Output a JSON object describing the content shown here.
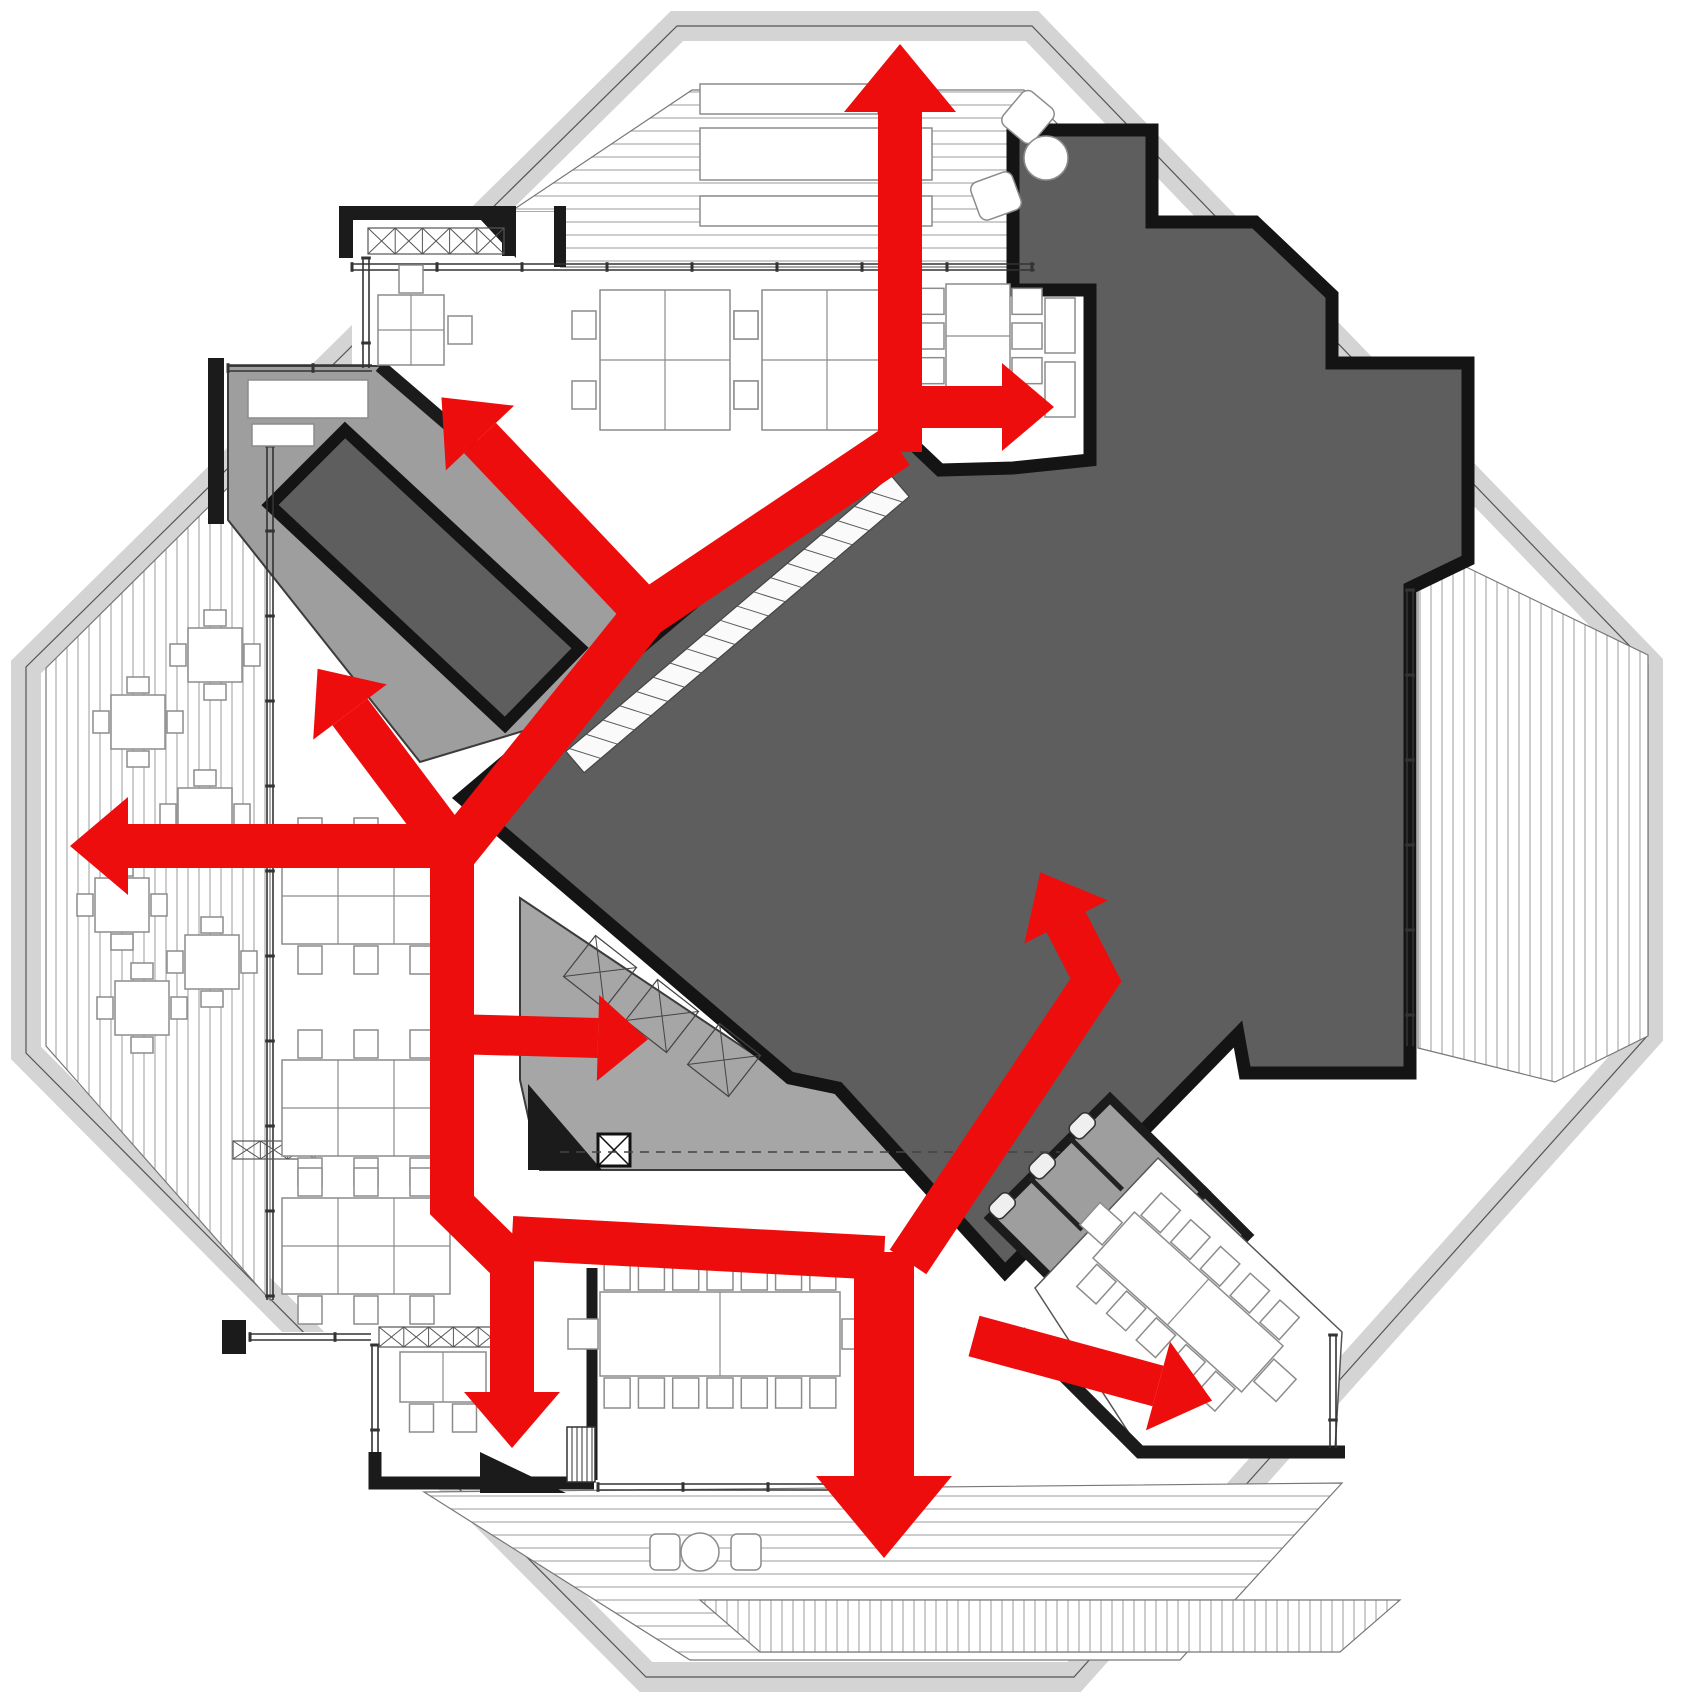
{
  "meta": {
    "kind": "architectural-floor-plan-circulation-diagram",
    "canvas": {
      "w": 1700,
      "h": 1701
    }
  },
  "palette": {
    "red": "#ee0d0d",
    "core_gray": "#5e5e5e",
    "core_stroke": "#141414",
    "room_gray": "#9e9e9e",
    "service_gray": "#a6a6a6",
    "band_gray": "#d4d4d4",
    "deck_line": "#b2b2b2",
    "wall_black": "#1b1b1b",
    "thin_line": "#3c3c3c",
    "furniture_line": "#8c8c8c",
    "white": "#ffffff",
    "hatch_line": "#5a5a5a"
  },
  "octagon": {
    "outer": [
      [
        672,
        14
      ],
      [
        1037,
        14
      ],
      [
        1660,
        660
      ],
      [
        1660,
        1040
      ],
      [
        1080,
        1689
      ],
      [
        640,
        1689
      ],
      [
        14,
        1059
      ],
      [
        14,
        662
      ]
    ],
    "inner": [
      [
        677,
        26
      ],
      [
        1032,
        26
      ],
      [
        1648,
        665
      ],
      [
        1648,
        1035
      ],
      [
        1074,
        1677
      ],
      [
        646,
        1677
      ],
      [
        26,
        1053
      ],
      [
        26,
        667
      ]
    ],
    "band_width": 30
  },
  "terraces": [
    {
      "name": "terrace-north",
      "pattern": "h",
      "points": [
        [
          692,
          90
        ],
        [
          1024,
          90
        ],
        [
          1160,
          228
        ],
        [
          1160,
          267
        ],
        [
          560,
          267
        ],
        [
          560,
          212
        ],
        [
          510,
          212
        ]
      ]
    },
    {
      "name": "terrace-west",
      "pattern": "v",
      "points": [
        [
          46,
          668
        ],
        [
          270,
          446
        ],
        [
          270,
          1300
        ],
        [
          46,
          1046
        ]
      ]
    },
    {
      "name": "terrace-east",
      "pattern": "v",
      "points": [
        [
          1418,
          588
        ],
        [
          1462,
          565
        ],
        [
          1648,
          655
        ],
        [
          1648,
          1036
        ],
        [
          1555,
          1082
        ],
        [
          1418,
          1048
        ]
      ]
    },
    {
      "name": "terrace-south",
      "pattern": "h",
      "points": [
        [
          424,
          1492
        ],
        [
          1342,
          1483
        ],
        [
          1180,
          1660
        ],
        [
          690,
          1660
        ]
      ]
    },
    {
      "name": "terrace-south-lower-strip",
      "pattern": "v",
      "points": [
        [
          700,
          1600
        ],
        [
          1400,
          1600
        ],
        [
          1340,
          1652
        ],
        [
          760,
          1652
        ]
      ]
    }
  ],
  "rooms": [
    {
      "name": "office-top-left",
      "fill": "white",
      "stroke": "none",
      "w": 0,
      "points": [
        [
          352,
          212
        ],
        [
          560,
          212
        ],
        [
          560,
          460
        ],
        [
          352,
          460
        ]
      ]
    },
    {
      "name": "room-sw-office",
      "fill": "white",
      "stroke": "none",
      "w": 0,
      "points": [
        [
          234,
          1332
        ],
        [
          590,
          1332
        ],
        [
          590,
          1483
        ],
        [
          375,
          1483
        ],
        [
          234,
          1355
        ]
      ]
    },
    {
      "name": "meeting-anteroom",
      "fill": "room_gray",
      "stroke": "thin_line",
      "w": 2,
      "points": [
        [
          228,
          366
        ],
        [
          380,
          366
        ],
        [
          652,
          600
        ],
        [
          560,
          720
        ],
        [
          420,
          762
        ],
        [
          228,
          520
        ]
      ]
    },
    {
      "name": "service-area",
      "fill": "service_gray",
      "stroke": "thin_line",
      "w": 2,
      "points": [
        [
          520,
          898
        ],
        [
          792,
          1080
        ],
        [
          1085,
          1080
        ],
        [
          1085,
          1170
        ],
        [
          540,
          1170
        ],
        [
          520,
          1080
        ]
      ]
    }
  ],
  "core": {
    "name": "central-core-mass",
    "points": [
      [
        462,
        798
      ],
      [
        898,
        430
      ],
      [
        940,
        470
      ],
      [
        1013,
        468
      ],
      [
        1090,
        460
      ],
      [
        1090,
        290
      ],
      [
        1013,
        290
      ],
      [
        1013,
        130
      ],
      [
        1152,
        130
      ],
      [
        1152,
        222
      ],
      [
        1255,
        222
      ],
      [
        1332,
        295
      ],
      [
        1332,
        363
      ],
      [
        1468,
        363
      ],
      [
        1468,
        560
      ],
      [
        1410,
        588
      ],
      [
        1410,
        1073
      ],
      [
        1245,
        1073
      ],
      [
        1238,
        1034
      ],
      [
        1005,
        1272
      ],
      [
        838,
        1088
      ],
      [
        790,
        1078
      ]
    ]
  },
  "meeting_room_rotated": {
    "name": "meeting-room-dark",
    "points": [
      [
        345,
        430
      ],
      [
        580,
        648
      ],
      [
        505,
        725
      ],
      [
        270,
        505
      ]
    ]
  },
  "toilets": {
    "block": [
      [
        1110,
        1098
      ],
      [
        1205,
        1192
      ],
      [
        1085,
        1312
      ],
      [
        990,
        1218
      ]
    ],
    "washroom": [
      [
        1205,
        1192
      ],
      [
        1248,
        1235
      ],
      [
        1128,
        1355
      ],
      [
        1085,
        1312
      ]
    ]
  },
  "se_meeting_room": {
    "name": "meeting-room-se",
    "points": [
      [
        1035,
        1288
      ],
      [
        1158,
        1158
      ],
      [
        1342,
        1332
      ],
      [
        1335,
        1450
      ],
      [
        1140,
        1450
      ]
    ]
  },
  "walls": [
    {
      "name": "wall-tl-office-top",
      "w": 14,
      "points": [
        [
          346,
          258
        ],
        [
          346,
          213
        ],
        [
          509,
          213
        ],
        [
          509,
          256
        ]
      ]
    },
    {
      "name": "wall-tl-office-divider",
      "w": 12,
      "points": [
        [
          560,
          206
        ],
        [
          560,
          267
        ]
      ]
    },
    {
      "name": "wall-anteroom-west",
      "w": 16,
      "points": [
        [
          216,
          358
        ],
        [
          216,
          524
        ]
      ]
    },
    {
      "name": "wall-anteroom-diagonal",
      "w": 13,
      "points": [
        [
          380,
          366
        ],
        [
          652,
          600
        ]
      ]
    },
    {
      "name": "wall-sw-corner",
      "w": 24,
      "points": [
        [
          234,
          1320
        ],
        [
          234,
          1354
        ]
      ]
    },
    {
      "name": "wall-s-left",
      "w": 13,
      "points": [
        [
          375,
          1452
        ],
        [
          375,
          1483
        ],
        [
          594,
          1483
        ]
      ]
    },
    {
      "name": "wall-conference-west",
      "w": 11,
      "points": [
        [
          592,
          1268
        ],
        [
          592,
          1480
        ]
      ]
    },
    {
      "name": "wall-se-room-southwest",
      "w": 13,
      "points": [
        [
          1020,
          1332
        ],
        [
          1140,
          1452
        ],
        [
          1345,
          1452
        ]
      ]
    }
  ],
  "wall_wedges": [
    {
      "name": "pier-tl-office",
      "points": [
        [
          468,
          206
        ],
        [
          516,
          206
        ],
        [
          516,
          258
        ]
      ]
    },
    {
      "name": "pier-s-wall",
      "points": [
        [
          480,
          1452
        ],
        [
          566,
          1493
        ],
        [
          480,
          1493
        ]
      ]
    },
    {
      "name": "pier-service-west",
      "points": [
        [
          528,
          1084
        ],
        [
          602,
          1170
        ],
        [
          528,
          1170
        ]
      ]
    }
  ],
  "windows": [
    {
      "name": "window-north-office",
      "a": [
        352,
        267
      ],
      "b": [
        1035,
        267
      ]
    },
    {
      "name": "window-tl-office",
      "a": [
        366,
        258
      ],
      "b": [
        366,
        368
      ]
    },
    {
      "name": "window-anteroom",
      "a": [
        228,
        368
      ],
      "b": [
        372,
        368
      ]
    },
    {
      "name": "window-west-office",
      "a": [
        270,
        446
      ],
      "b": [
        270,
        1300
      ]
    },
    {
      "name": "window-core-east",
      "a": [
        1410,
        590
      ],
      "b": [
        1410,
        1046
      ]
    },
    {
      "name": "window-se-room",
      "a": [
        1333,
        1335
      ],
      "b": [
        1333,
        1448
      ]
    },
    {
      "name": "window-sw-room-top",
      "a": [
        250,
        1337
      ],
      "b": [
        371,
        1337
      ]
    },
    {
      "name": "window-sw-room-right",
      "a": [
        375,
        1345
      ],
      "b": [
        375,
        1452
      ]
    },
    {
      "name": "window-conference-south",
      "a": [
        598,
        1487
      ],
      "b": [
        858,
        1487
      ]
    }
  ],
  "xbands": [
    {
      "name": "hatch-band-tl-office",
      "x": 368,
      "y": 228,
      "w": 136,
      "h": 26,
      "cells": 5
    },
    {
      "name": "hatch-band-sw-room",
      "x": 379,
      "y": 1327,
      "w": 124,
      "h": 20,
      "cells": 5
    },
    {
      "name": "hatch-band-west-office",
      "x": 233,
      "y": 1141,
      "w": 82,
      "h": 18,
      "cells": 3
    }
  ],
  "ladder_stair": {
    "name": "stair-ladder-core-edge",
    "a": [
      575,
      762
    ],
    "b": [
      900,
      486
    ],
    "w": 28,
    "step": 22
  },
  "stair_south": {
    "name": "stair-south-exit",
    "x": 567,
    "y": 1427,
    "w": 28,
    "h": 55,
    "gap": 5
  },
  "furniture": {
    "desk_clusters": [
      {
        "name": "desks-north-1",
        "x": 600,
        "y": 290,
        "w": 130,
        "h": 140,
        "rows": 2,
        "cols": 2,
        "left": 2,
        "right": 2,
        "top": 0,
        "bottom": 0
      },
      {
        "name": "desks-north-2",
        "x": 762,
        "y": 290,
        "w": 130,
        "h": 140,
        "rows": 2,
        "cols": 2,
        "left": 2,
        "right": 2,
        "top": 0,
        "bottom": 0
      },
      {
        "name": "desks-west-1",
        "x": 282,
        "y": 848,
        "w": 168,
        "h": 96,
        "rows": 2,
        "cols": 3,
        "left": 0,
        "right": 0,
        "top": 3,
        "bottom": 3
      },
      {
        "name": "desks-west-2",
        "x": 282,
        "y": 1060,
        "w": 168,
        "h": 96,
        "rows": 2,
        "cols": 3,
        "left": 0,
        "right": 0,
        "top": 3,
        "bottom": 3
      },
      {
        "name": "desks-west-3",
        "x": 282,
        "y": 1198,
        "w": 168,
        "h": 96,
        "rows": 2,
        "cols": 3,
        "left": 0,
        "right": 0,
        "top": 3,
        "bottom": 3
      },
      {
        "name": "desks-tl-office",
        "x": 378,
        "y": 295,
        "w": 66,
        "h": 70,
        "rows": 2,
        "cols": 2,
        "left": 0,
        "right": 1,
        "top": 1,
        "bottom": 0
      },
      {
        "name": "desks-sw-room",
        "x": 400,
        "y": 1352,
        "w": 86,
        "h": 50,
        "rows": 1,
        "cols": 2,
        "left": 0,
        "right": 0,
        "top": 0,
        "bottom": 2
      }
    ],
    "meeting_tables": [
      {
        "name": "table-north-east",
        "cx": 978,
        "cy": 336,
        "len": 104,
        "wid": 64,
        "rot": 90,
        "side": 3,
        "ends": 0
      },
      {
        "name": "table-conference",
        "cx": 720,
        "cy": 1334,
        "len": 240,
        "wid": 84,
        "rot": 0,
        "side": 7,
        "ends": 1
      },
      {
        "name": "table-se-meeting",
        "cx": 1188,
        "cy": 1302,
        "len": 200,
        "wid": 62,
        "rot": 42,
        "side": 5,
        "ends": 1
      }
    ],
    "cafe_tables": [
      [
        215,
        655
      ],
      [
        138,
        722
      ],
      [
        205,
        815
      ],
      [
        122,
        905
      ],
      [
        212,
        962
      ],
      [
        142,
        1008
      ]
    ],
    "planters": [
      {
        "x": 700,
        "y": 84,
        "w": 178,
        "h": 30
      },
      {
        "x": 700,
        "y": 128,
        "w": 232,
        "h": 52
      },
      {
        "x": 700,
        "y": 196,
        "w": 232,
        "h": 30
      }
    ],
    "lounge_chairs": [
      {
        "cx": 1028,
        "cy": 117,
        "rot": 40
      },
      {
        "cx": 996,
        "cy": 196,
        "rot": 70
      }
    ],
    "lounge_table": {
      "cx": 1046,
      "cy": 158,
      "r": 22
    },
    "south_chairs": [
      {
        "x": 650,
        "y": 1534,
        "w": 30,
        "h": 36
      },
      {
        "x": 731,
        "y": 1534,
        "w": 30,
        "h": 36
      }
    ],
    "south_table": {
      "cx": 700,
      "cy": 1552,
      "r": 19
    },
    "single_desks": [
      {
        "x": 1045,
        "y": 298,
        "w": 30,
        "h": 55
      },
      {
        "x": 1045,
        "y": 362,
        "w": 30,
        "h": 55
      },
      {
        "x": 248,
        "y": 380,
        "w": 120,
        "h": 38
      },
      {
        "x": 252,
        "y": 424,
        "w": 62,
        "h": 22
      }
    ],
    "service_boxes": [
      {
        "cx": 600,
        "cy": 972
      },
      {
        "cx": 662,
        "cy": 1016
      },
      {
        "cx": 724,
        "cy": 1060
      }
    ],
    "service_shaft": {
      "x": 598,
      "y": 1134,
      "w": 32,
      "h": 32
    },
    "service_counter": {
      "a": [
        560,
        1152
      ],
      "b": [
        1060,
        1152
      ]
    }
  },
  "arrows": [
    {
      "name": "flow-trunk-nw-corridor",
      "points": [
        [
          897,
          446
        ],
        [
          645,
          615
        ],
        [
          456,
          850
        ]
      ],
      "w": 46,
      "head": null
    },
    {
      "name": "flow-trunk-south-leg",
      "points": [
        [
          452,
          844
        ],
        [
          452,
          1205
        ],
        [
          512,
          1264
        ],
        [
          512,
          1392
        ]
      ],
      "w": 44,
      "head": {
        "l": 56,
        "w": 96
      }
    },
    {
      "name": "flow-trunk-south-corridor",
      "points": [
        [
          512,
          1238
        ],
        [
          884,
          1258
        ]
      ],
      "w": 44,
      "head": null
    },
    {
      "name": "flow-north-exit",
      "points": [
        [
          900,
          452
        ],
        [
          900,
          112
        ]
      ],
      "w": 44,
      "head": {
        "l": 68,
        "w": 112
      }
    },
    {
      "name": "flow-northeast-branch",
      "points": [
        [
          896,
          407
        ],
        [
          1002,
          407
        ]
      ],
      "w": 42,
      "head": {
        "l": 52,
        "w": 88
      }
    },
    {
      "name": "flow-to-topleft-office",
      "points": [
        [
          645,
          612
        ],
        [
          480,
          438
        ]
      ],
      "w": 44,
      "head": {
        "l": 56,
        "w": 94
      }
    },
    {
      "name": "flow-nnw-small",
      "points": [
        [
          452,
          848
        ],
        [
          350,
          712
        ]
      ],
      "w": 44,
      "head": {
        "l": 54,
        "w": 92
      }
    },
    {
      "name": "flow-west-exit",
      "points": [
        [
          454,
          846
        ],
        [
          128,
          846
        ]
      ],
      "w": 44,
      "head": {
        "l": 58,
        "w": 98
      }
    },
    {
      "name": "flow-east-service-branch",
      "points": [
        [
          452,
          1034
        ],
        [
          598,
          1038
        ]
      ],
      "w": 40,
      "head": {
        "l": 50,
        "w": 86
      }
    },
    {
      "name": "flow-south-exit",
      "points": [
        [
          884,
          1252
        ],
        [
          884,
          1476
        ]
      ],
      "w": 60,
      "head": {
        "l": 82,
        "w": 136
      }
    },
    {
      "name": "flow-into-core",
      "points": [
        [
          908,
          1262
        ],
        [
          1096,
          980
        ],
        [
          1066,
          922
        ]
      ],
      "w": 44,
      "head": {
        "l": 56,
        "w": 94
      }
    },
    {
      "name": "flow-to-se-meeting",
      "points": [
        [
          974,
          1336
        ],
        [
          1158,
          1386
        ]
      ],
      "w": 42,
      "head": {
        "l": 56,
        "w": 92
      }
    }
  ]
}
